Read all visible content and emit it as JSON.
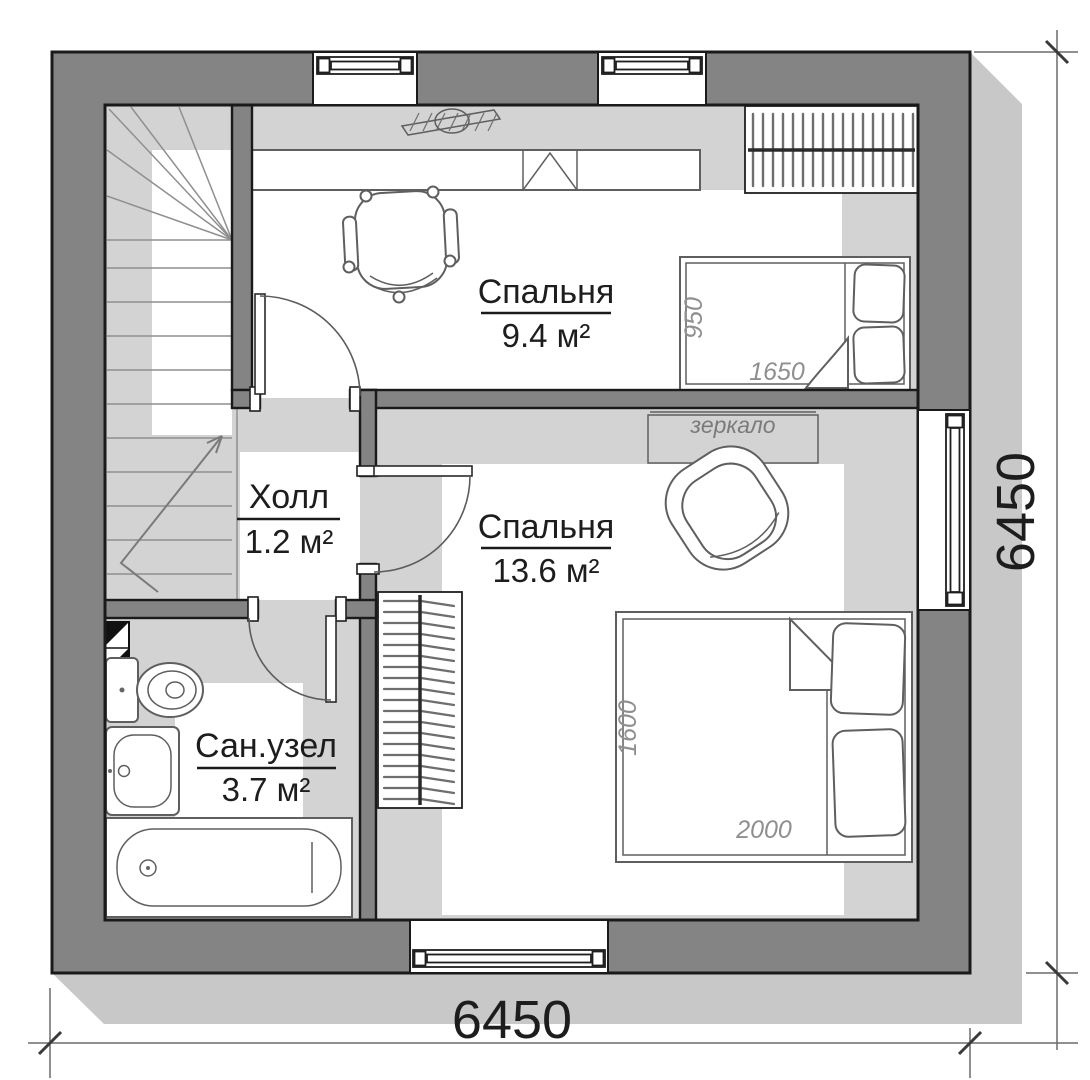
{
  "rooms": [
    {
      "name": "Спальня",
      "area": "9.4 м²"
    },
    {
      "name": "Спальня",
      "area": "13.6 м²"
    },
    {
      "name": "Холл",
      "area": "1.2 м²"
    },
    {
      "name": "Сан.узел",
      "area": "3.7 м²"
    }
  ],
  "dimensions": {
    "bottom": "6450",
    "right": "6450"
  },
  "furniture": {
    "mirror_label": "зеркало",
    "bed_single": {
      "width": "950",
      "length": "1650"
    },
    "bed_double": {
      "width": "1600",
      "length": "2000"
    }
  },
  "colors": {
    "wall_fill": "#848484",
    "outline": "#1a1a1a",
    "floor_shade": "#d3d3d3",
    "building_shadow": "#c8c8c8",
    "furniture_stroke": "#5f5f5f",
    "dim_text": "#1d1d1d",
    "dim_italic": "#8f8f8f"
  }
}
